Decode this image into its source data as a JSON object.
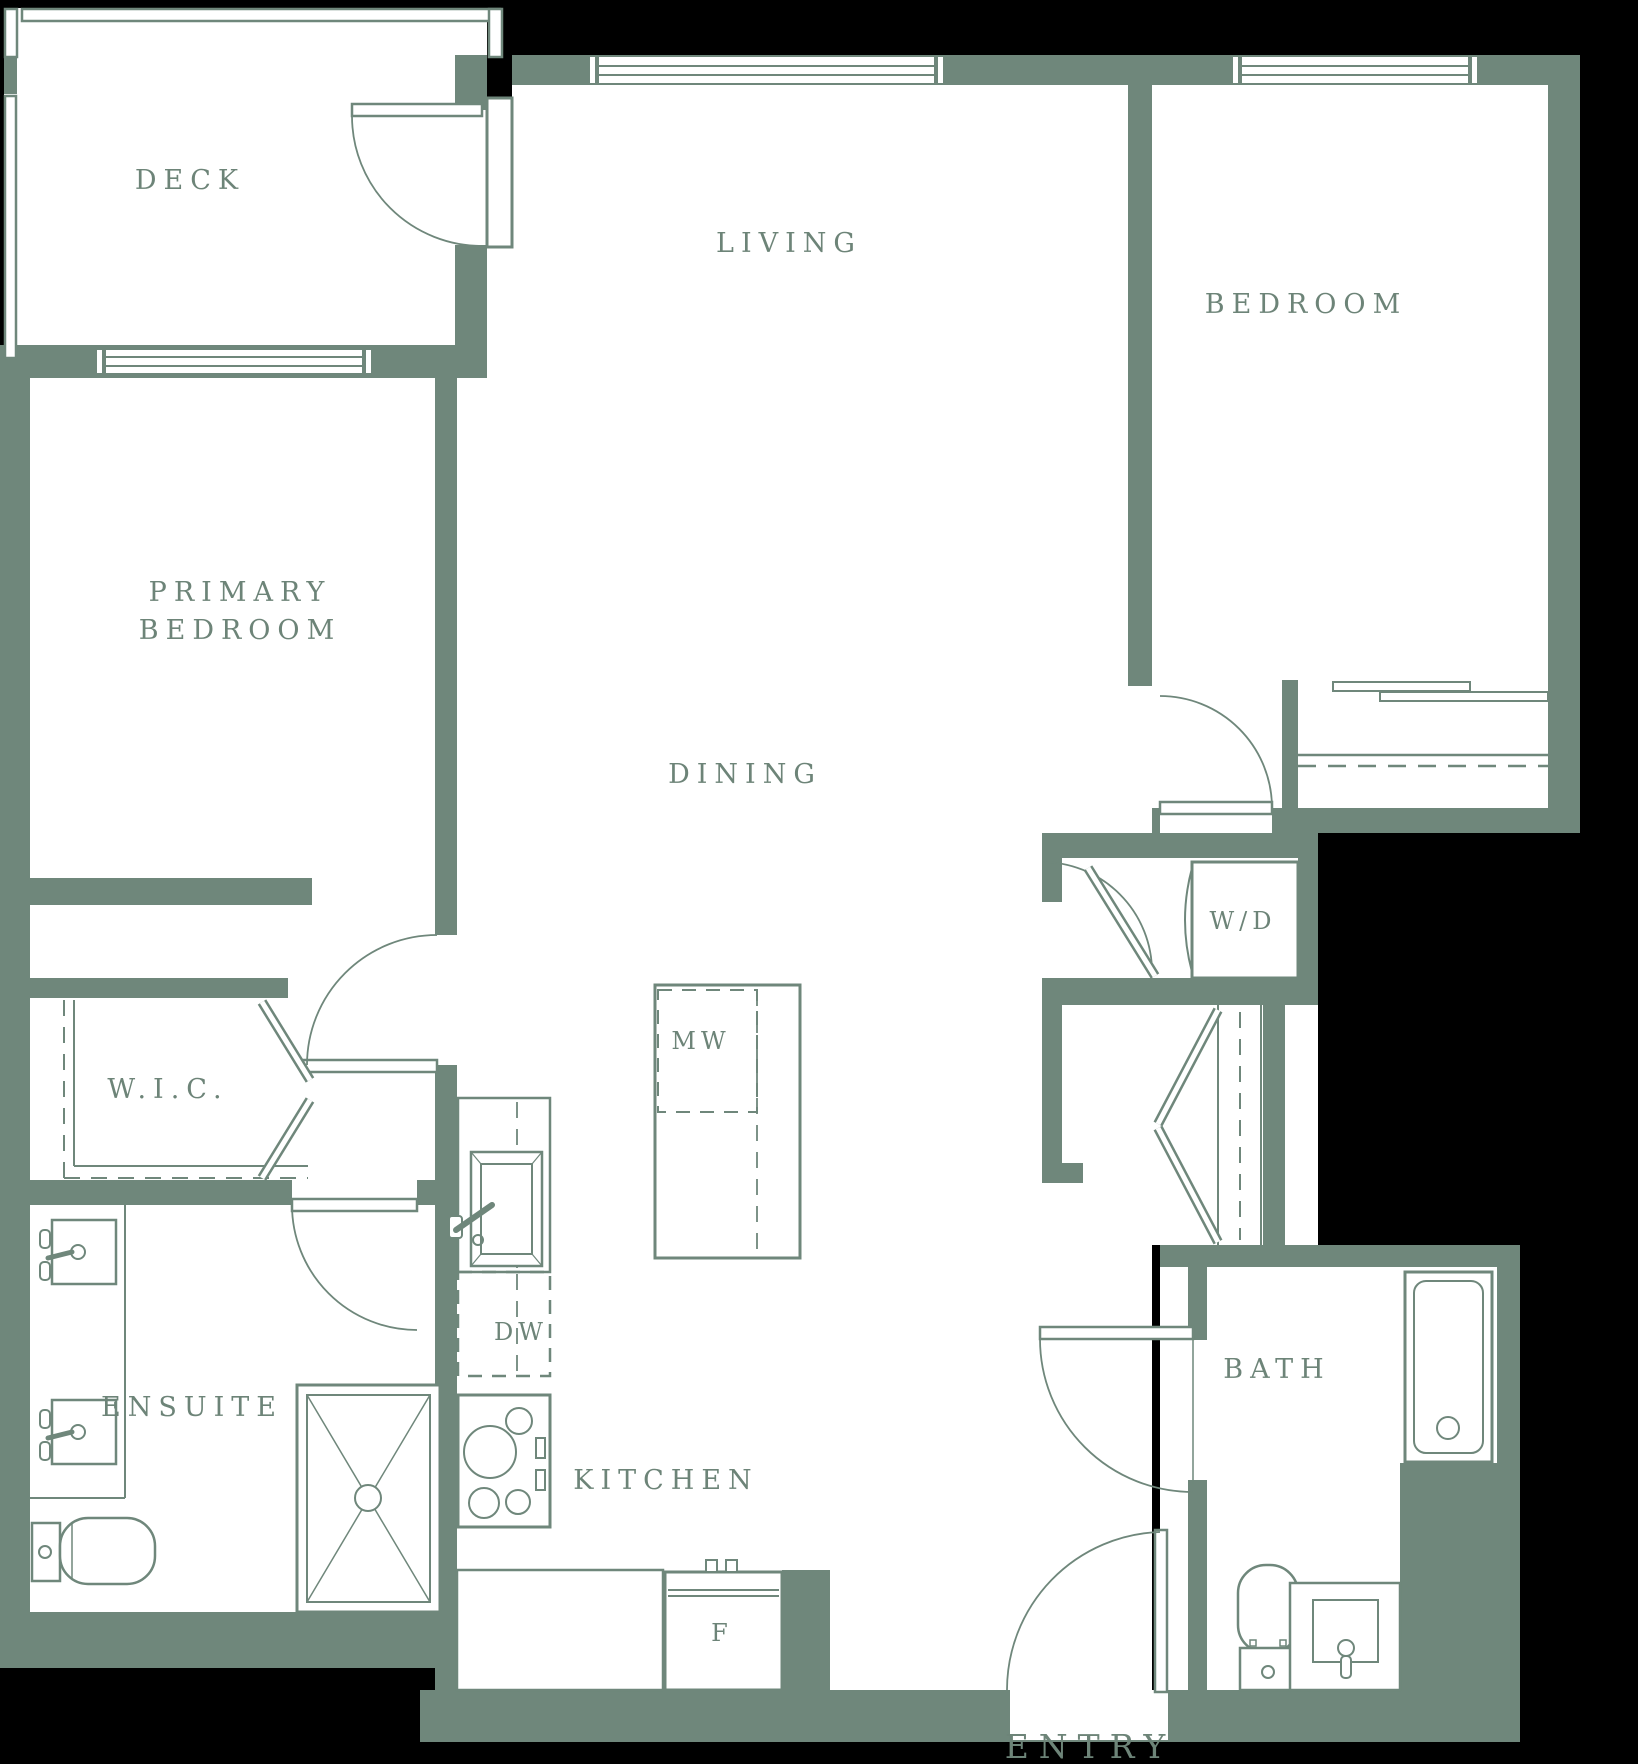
{
  "title": "Apartment floor plan",
  "colors": {
    "wall": "#6f877b",
    "floor": "#ffffff",
    "background": "#000000",
    "label_text": "#6d8478"
  },
  "labels": {
    "deck": {
      "text": "DECK"
    },
    "living": {
      "text": "LIVING"
    },
    "bedroom": {
      "text": "BEDROOM"
    },
    "primary_line1": {
      "text": "PRIMARY"
    },
    "primary_line2": {
      "text": "BEDROOM"
    },
    "dining": {
      "text": "DINING"
    },
    "washer_dryer": {
      "text": "W/D"
    },
    "walk_in_closet": {
      "text": "W.I.C."
    },
    "microwave": {
      "text": "MW"
    },
    "dishwasher": {
      "text": "DW"
    },
    "ensuite": {
      "text": "ENSUITE"
    },
    "kitchen": {
      "text": "KITCHEN"
    },
    "bath": {
      "text": "BATH"
    },
    "fridge": {
      "text": "F"
    },
    "entry": {
      "text": "ENTRY"
    }
  }
}
